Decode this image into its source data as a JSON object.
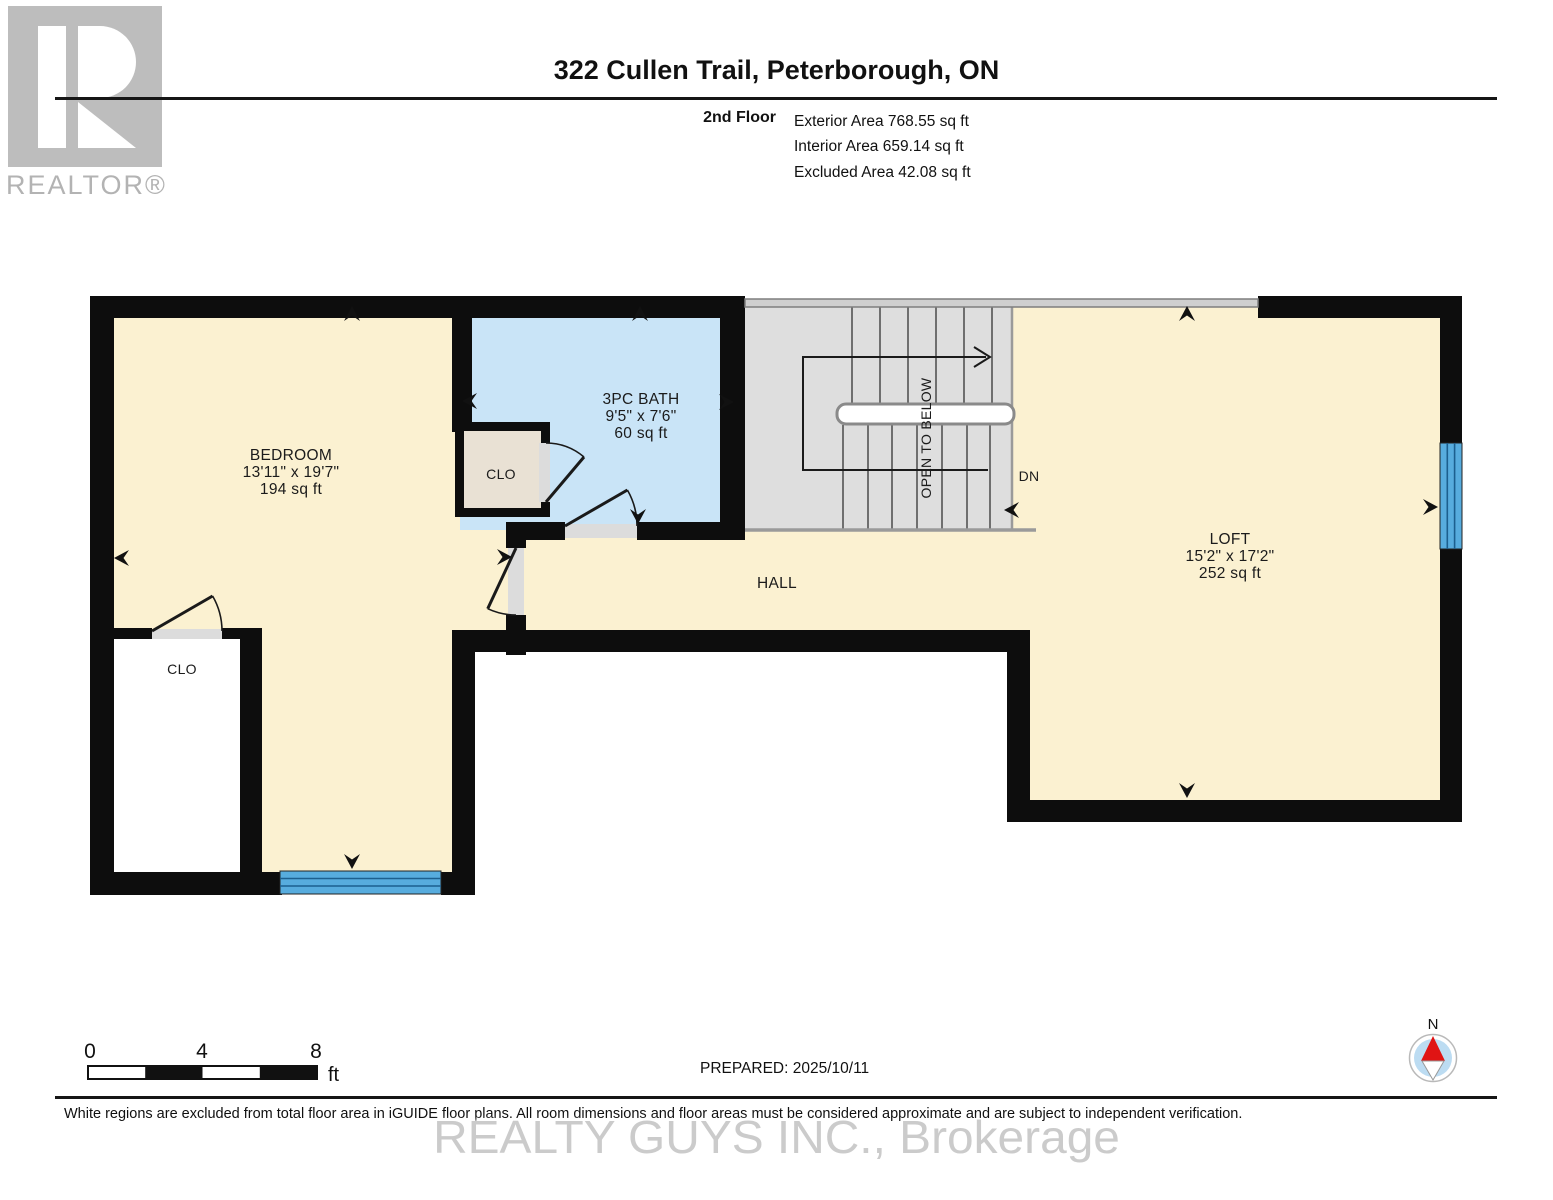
{
  "header": {
    "logo_letter": "R",
    "logo_label": "REALTOR®",
    "title": "322 Cullen Trail, Peterborough, ON",
    "floor_label": "2nd Floor",
    "area_lines": [
      "Exterior Area 768.55 sq ft",
      "Interior Area 659.14 sq ft",
      "Excluded Area 42.08 sq ft"
    ]
  },
  "plan": {
    "bedroom": {
      "name": "BEDROOM",
      "dims": "13'11\" x 19'7\"",
      "area": "194 sq ft"
    },
    "bath": {
      "name": "3PC BATH",
      "dims": "9'5\" x 7'6\"",
      "area": "60 sq ft"
    },
    "loft": {
      "name": "LOFT",
      "dims": "15'2\" x 17'2\"",
      "area": "252 sq ft"
    },
    "hall_label": "HALL",
    "bath_closet_label": "CLO",
    "bedroom_closet_label": "CLO",
    "stairs_note": "OPEN TO BELOW",
    "stairs_down_label": "DN"
  },
  "footer": {
    "scale_ticks": [
      "0",
      "4",
      "8"
    ],
    "scale_unit": "ft",
    "prepared": "PREPARED: 2025/10/11",
    "compass_north_label": "N",
    "disclaimer": "White regions are excluded from total floor area in iGUIDE floor plans. All room dimensions and floor areas must be considered approximate and are subject to independent verification.",
    "watermark": "REALTY GUYS INC., Brokerage"
  },
  "colors": {
    "room_fill": "#FBF1D1",
    "bath_fill": "#C9E4F7",
    "stairs_fill": "#DEDEDE",
    "closet_fill": "#E9E1D4",
    "wall": "#0D0D0D",
    "door_sill": "#DCDCDC",
    "window_blue": "#57ACDE",
    "compass_red": "#E01414",
    "logo_gray": "#BDBDBD",
    "watermark_gray": "#C3C3C3"
  }
}
